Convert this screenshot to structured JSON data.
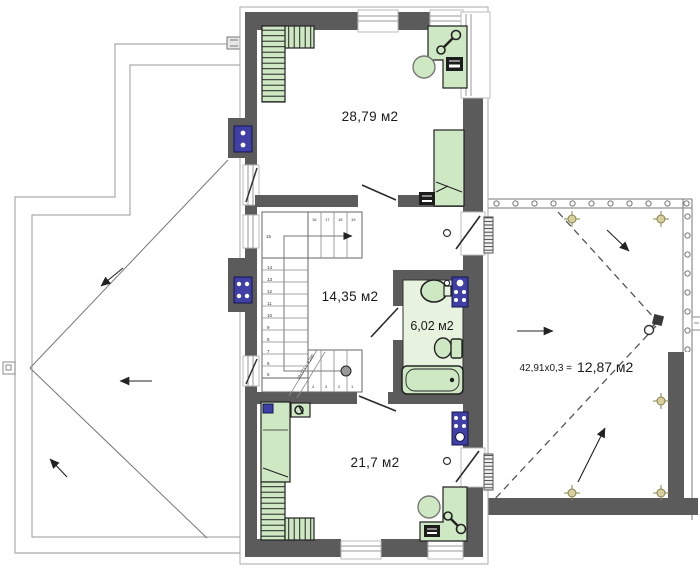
{
  "plan": {
    "rooms": {
      "bedroom_top_area": "28,79 м2",
      "hall_area": "14,35 м2",
      "bathroom_area": "6,02 м2",
      "bedroom_bottom_area": "21,7 м2"
    },
    "terrace": {
      "formula_left": "42,91x0,3 =",
      "formula_right": "12,87 м2"
    },
    "stairs": {
      "annotation": "19x173 = 3,290",
      "landing_number": "15",
      "low_number": "5",
      "left_numbers": [
        "14",
        "13",
        "12",
        "11",
        "10",
        "9",
        "8",
        "7",
        "6"
      ],
      "top_numbers": [
        "16",
        "17",
        "18",
        "19"
      ],
      "bottom_numbers": [
        "4",
        "3",
        "2",
        "1"
      ]
    },
    "colors": {
      "wall": "#5b5b5b",
      "furniture_green": "#cfe8c4",
      "bathroom_floor": "#e7f2df",
      "fixture_blue": "#3f3fa6",
      "roof_marker_olive": "#d8d09c"
    },
    "icons": [
      "wardrobe-icon",
      "desk-icon",
      "chair-icon",
      "bed-icon",
      "lamp-icon",
      "tv-icon",
      "sink-icon",
      "toilet-icon",
      "bathtub-icon",
      "washing-machine-icon",
      "boiler-icon",
      "vent-block-icon",
      "roof-drain-icon",
      "slope-arrow-icon",
      "stairs-icon",
      "door-icon",
      "window-icon",
      "railing-icon"
    ]
  }
}
